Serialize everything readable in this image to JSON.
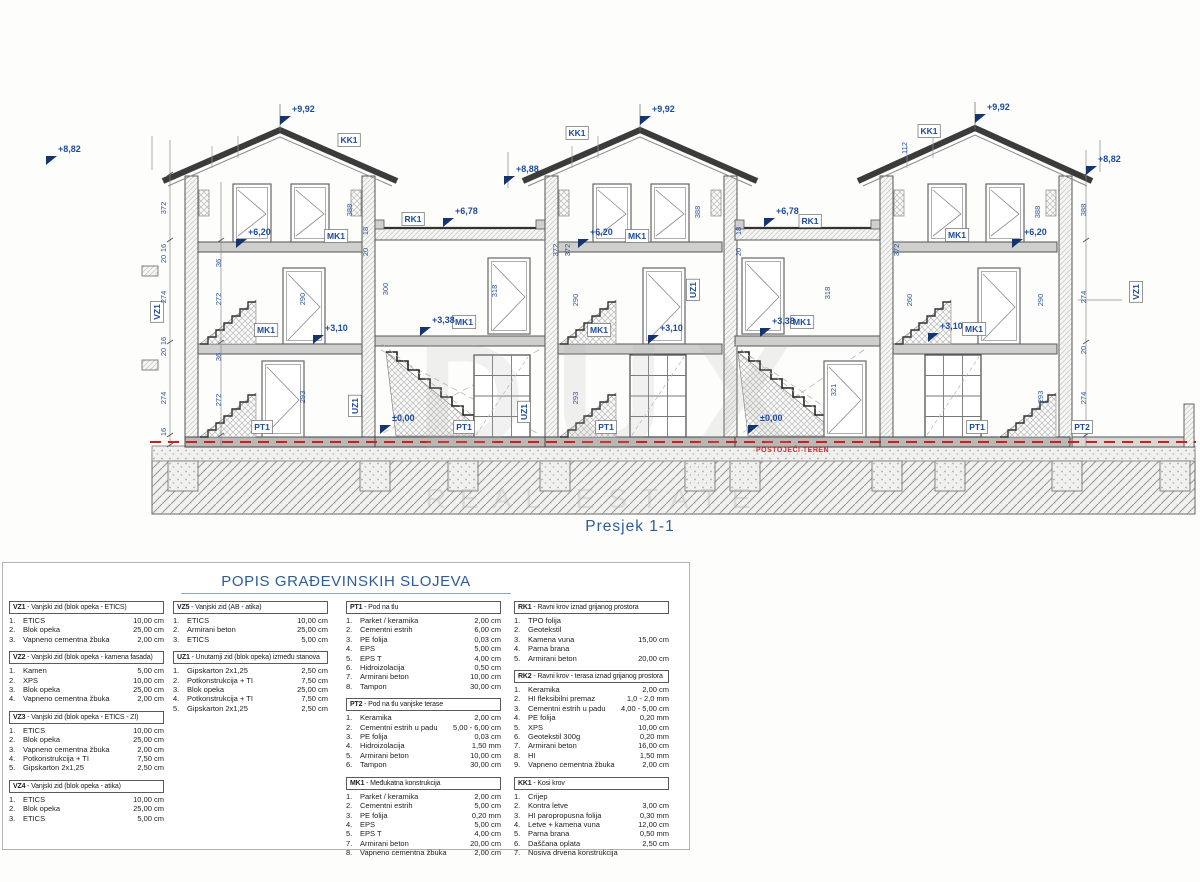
{
  "drawing": {
    "caption": "Presjek 1-1",
    "watermark_line1": "DUX",
    "watermark_line2": "REAL ESTATE",
    "terrain_label": "POSTOJEĆI TEREN",
    "colors": {
      "annotation_blue": "#1c4a9e",
      "terrain_red": "#d32f2f",
      "title_blue": "#2b5c9e"
    },
    "tags": [
      {
        "t": "KK1",
        "x": 349,
        "y": 140
      },
      {
        "t": "KK1",
        "x": 577,
        "y": 133
      },
      {
        "t": "KK1",
        "x": 929,
        "y": 131
      },
      {
        "t": "RK1",
        "x": 413,
        "y": 219
      },
      {
        "t": "RK1",
        "x": 810,
        "y": 221
      },
      {
        "t": "MK1",
        "x": 336,
        "y": 236
      },
      {
        "t": "MK1",
        "x": 637,
        "y": 236
      },
      {
        "t": "MK1",
        "x": 957,
        "y": 235
      },
      {
        "t": "MK1",
        "x": 266,
        "y": 330
      },
      {
        "t": "MK1",
        "x": 599,
        "y": 330
      },
      {
        "t": "MK1",
        "x": 974,
        "y": 329
      },
      {
        "t": "MK1",
        "x": 464,
        "y": 322
      },
      {
        "t": "MK1",
        "x": 802,
        "y": 322
      },
      {
        "t": "PT1",
        "x": 262,
        "y": 427
      },
      {
        "t": "PT1",
        "x": 464,
        "y": 427
      },
      {
        "t": "PT1",
        "x": 606,
        "y": 427
      },
      {
        "t": "PT1",
        "x": 977,
        "y": 427
      },
      {
        "t": "PT2",
        "x": 1082,
        "y": 427
      },
      {
        "t": "VZ1",
        "x": 157,
        "y": 312,
        "rot": 1
      },
      {
        "t": "VZ1",
        "x": 1136,
        "y": 292,
        "rot": 1
      },
      {
        "t": "UZ1",
        "x": 355,
        "y": 406,
        "rot": 1
      },
      {
        "t": "UZ1",
        "x": 524,
        "y": 412,
        "rot": 1
      },
      {
        "t": "UZ1",
        "x": 693,
        "y": 290,
        "rot": 1
      }
    ],
    "elevations": [
      {
        "t": "+9,92",
        "x": 292,
        "y": 112
      },
      {
        "t": "+9,92",
        "x": 652,
        "y": 112
      },
      {
        "t": "+9,92",
        "x": 987,
        "y": 110
      },
      {
        "t": "+8,82",
        "x": 58,
        "y": 152
      },
      {
        "t": "+8,88",
        "x": 516,
        "y": 172
      },
      {
        "t": "+8,82",
        "x": 1098,
        "y": 162
      },
      {
        "t": "+6,78",
        "x": 455,
        "y": 214
      },
      {
        "t": "+6,78",
        "x": 776,
        "y": 214
      },
      {
        "t": "+6,20",
        "x": 248,
        "y": 235
      },
      {
        "t": "+6,20",
        "x": 590,
        "y": 235
      },
      {
        "t": "+6,20",
        "x": 1024,
        "y": 235
      },
      {
        "t": "+3,10",
        "x": 325,
        "y": 331
      },
      {
        "t": "+3,10",
        "x": 660,
        "y": 331
      },
      {
        "t": "+3,10",
        "x": 940,
        "y": 329
      },
      {
        "t": "+3,38",
        "x": 432,
        "y": 323
      },
      {
        "t": "+3,38",
        "x": 772,
        "y": 324
      },
      {
        "t": "±0,00",
        "x": 392,
        "y": 421
      },
      {
        "t": "±0,00",
        "x": 760,
        "y": 421
      }
    ],
    "dims": [
      {
        "t": "372",
        "x": 166,
        "y": 208
      },
      {
        "t": "16",
        "x": 166,
        "y": 248
      },
      {
        "t": "20",
        "x": 166,
        "y": 259
      },
      {
        "t": "274",
        "x": 166,
        "y": 297
      },
      {
        "t": "16",
        "x": 166,
        "y": 341
      },
      {
        "t": "20",
        "x": 166,
        "y": 352
      },
      {
        "t": "274",
        "x": 166,
        "y": 398
      },
      {
        "t": "16",
        "x": 166,
        "y": 432
      },
      {
        "t": "36",
        "x": 221,
        "y": 263
      },
      {
        "t": "272",
        "x": 221,
        "y": 299
      },
      {
        "t": "36",
        "x": 221,
        "y": 357
      },
      {
        "t": "272",
        "x": 221,
        "y": 400
      },
      {
        "t": "388",
        "x": 352,
        "y": 210
      },
      {
        "t": "290",
        "x": 305,
        "y": 299
      },
      {
        "t": "293",
        "x": 305,
        "y": 397
      },
      {
        "t": "300",
        "x": 388,
        "y": 289
      },
      {
        "t": "318",
        "x": 497,
        "y": 291
      },
      {
        "t": "18",
        "x": 368,
        "y": 231
      },
      {
        "t": "20",
        "x": 368,
        "y": 252
      },
      {
        "t": "372",
        "x": 558,
        "y": 250
      },
      {
        "t": "372",
        "x": 570,
        "y": 250
      },
      {
        "t": "290",
        "x": 578,
        "y": 300
      },
      {
        "t": "293",
        "x": 578,
        "y": 398
      },
      {
        "t": "388",
        "x": 700,
        "y": 212
      },
      {
        "t": "318",
        "x": 830,
        "y": 293
      },
      {
        "t": "321",
        "x": 836,
        "y": 390
      },
      {
        "t": "18",
        "x": 741,
        "y": 231
      },
      {
        "t": "20",
        "x": 741,
        "y": 252
      },
      {
        "t": "112",
        "x": 907,
        "y": 148
      },
      {
        "t": "372",
        "x": 899,
        "y": 250
      },
      {
        "t": "260",
        "x": 912,
        "y": 300
      },
      {
        "t": "290",
        "x": 1043,
        "y": 300
      },
      {
        "t": "293",
        "x": 1043,
        "y": 397
      },
      {
        "t": "388",
        "x": 1040,
        "y": 212
      },
      {
        "t": "388",
        "x": 1086,
        "y": 210
      },
      {
        "t": "274",
        "x": 1086,
        "y": 297
      },
      {
        "t": "274",
        "x": 1086,
        "y": 398
      },
      {
        "t": "20",
        "x": 1086,
        "y": 350
      }
    ]
  },
  "table": {
    "title": "POPIS GRAĐEVINSKIH SLOJEVA",
    "columns": [
      {
        "blocks": [
          {
            "code": "VZ1",
            "title": "Vanjski zid (blok opeka - ETICS)",
            "rows": [
              [
                "1.",
                "ETICS",
                "10,00 cm"
              ],
              [
                "2.",
                "Blok opeka",
                "25,00 cm"
              ],
              [
                "3.",
                "Vapneno cementna žbuka",
                "2,00 cm"
              ]
            ]
          },
          {
            "code": "VZ2",
            "title": "Vanjski zid (blok opeka - kamena fasada)",
            "rows": [
              [
                "1.",
                "Kamen",
                "5,00 cm"
              ],
              [
                "2.",
                "XPS",
                "10,00 cm"
              ],
              [
                "3.",
                "Blok opeka",
                "25,00 cm"
              ],
              [
                "4.",
                "Vapneno cementna žbuka",
                "2,00 cm"
              ]
            ]
          },
          {
            "code": "VZ3",
            "title": "Vanjski zid (blok opeka - ETICS - ZI)",
            "rows": [
              [
                "1.",
                "ETICS",
                "10,00 cm"
              ],
              [
                "2.",
                "Blok opeka",
                "25,00 cm"
              ],
              [
                "3.",
                "Vapneno cementna žbuka",
                "2,00 cm"
              ],
              [
                "4.",
                "Potkonstrukcija + TI",
                "7,50 cm"
              ],
              [
                "5.",
                "Gipskarton 2x1,25",
                "2,50 cm"
              ]
            ]
          },
          {
            "code": "VZ4",
            "title": "Vanjski zid (blok opeka - atika)",
            "rows": [
              [
                "1.",
                "ETICS",
                "10,00 cm"
              ],
              [
                "2.",
                "Blok opeka",
                "25,00 cm"
              ],
              [
                "3.",
                "ETICS",
                "5,00 cm"
              ]
            ]
          }
        ]
      },
      {
        "blocks": [
          {
            "code": "VZ5",
            "title": "Vanjski zid (AB - atika)",
            "rows": [
              [
                "1.",
                "ETICS",
                "10,00 cm"
              ],
              [
                "2.",
                "Armirani beton",
                "25,00 cm"
              ],
              [
                "3.",
                "ETICS",
                "5,00 cm"
              ]
            ]
          },
          {
            "code": "UZ1",
            "title": "Unutarnji zid (blok opeka) između stanova",
            "rows": [
              [
                "1.",
                "Gipskarton 2x1,25",
                "2,50 cm"
              ],
              [
                "2.",
                "Potkonstrukcija + TI",
                "7,50 cm"
              ],
              [
                "3.",
                "Blok opeka",
                "25,00 cm"
              ],
              [
                "4.",
                "Potkonstrukcija + TI",
                "7,50 cm"
              ],
              [
                "5.",
                "Gipskarton 2x1,25",
                "2,50 cm"
              ]
            ]
          }
        ]
      },
      {
        "blocks": [
          {
            "code": "PT1",
            "title": "Pod na tlu",
            "rows": [
              [
                "1.",
                "Parket / keramika",
                "2,00 cm"
              ],
              [
                "2.",
                "Cementni estrih",
                "6,00 cm"
              ],
              [
                "3.",
                "PE folija",
                "0,03 cm"
              ],
              [
                "4.",
                "EPS",
                "5,00 cm"
              ],
              [
                "5.",
                "EPS T",
                "4,00 cm"
              ],
              [
                "6.",
                "Hidroizolacija",
                "0,50 cm"
              ],
              [
                "7.",
                "Armirani beton",
                "10,00 cm"
              ],
              [
                "8.",
                "Tampon",
                "30,00 cm"
              ]
            ]
          },
          {
            "code": "PT2",
            "title": "Pod na tlu vanjske terase",
            "rows": [
              [
                "1.",
                "Keramika",
                "2,00 cm"
              ],
              [
                "2.",
                "Cementni estrih u padu",
                "5,00 - 6,00 cm"
              ],
              [
                "3.",
                "PE folija",
                "0,03 cm"
              ],
              [
                "4.",
                "Hidroizolacija",
                "1,50 mm"
              ],
              [
                "5.",
                "Armirani beton",
                "10,00 cm"
              ],
              [
                "6.",
                "Tampon",
                "30,00 cm"
              ]
            ]
          },
          {
            "code": "MK1",
            "title": "Međukatna konstrukcija",
            "rows": [
              [
                "1.",
                "Parket / keramika",
                "2,00 cm"
              ],
              [
                "2.",
                "Cementni estrih",
                "5,00 cm"
              ],
              [
                "3.",
                "PE folija",
                "0,20 mm"
              ],
              [
                "4.",
                "EPS",
                "5,00 cm"
              ],
              [
                "5.",
                "EPS T",
                "4,00 cm"
              ],
              [
                "7.",
                "Armirani beton",
                "20,00 cm"
              ],
              [
                "8.",
                "Vapneno cementna žbuka",
                "2,00 cm"
              ]
            ]
          }
        ]
      },
      {
        "blocks": [
          {
            "code": "RK1",
            "title": "Ravni krov iznad grijanog prostora",
            "rows": [
              [
                "1.",
                "TPO folija",
                ""
              ],
              [
                "2.",
                "Geotekstil",
                ""
              ],
              [
                "3.",
                "Kamena vuna",
                "15,00 cm"
              ],
              [
                "4.",
                "Parna brana",
                ""
              ],
              [
                "5.",
                "Armirani beton",
                "20,00 cm"
              ]
            ]
          },
          {
            "code": "RK2",
            "title": "Ravni krov - terasa iznad grijanog prostora",
            "rows": [
              [
                "1.",
                "Keramika",
                "2,00 cm"
              ],
              [
                "2.",
                "HI fleksibilni premaz",
                "1,0 - 2,0 mm"
              ],
              [
                "3.",
                "Cementni estrih u padu",
                "4,00 - 5,00 cm"
              ],
              [
                "4.",
                "PE folija",
                "0,20 mm"
              ],
              [
                "5.",
                "XPS",
                "10,00 cm"
              ],
              [
                "6.",
                "Geotekstil 300g",
                "0,20 mm"
              ],
              [
                "7.",
                "Armirani beton",
                "16,00 cm"
              ],
              [
                "8.",
                "HI",
                "1,50 mm"
              ],
              [
                "9.",
                "Vapneno cementna žbuka",
                "2,00 cm"
              ]
            ]
          },
          {
            "code": "KK1",
            "title": "Kosi krov",
            "rows": [
              [
                "1.",
                "Crijep",
                ""
              ],
              [
                "2.",
                "Kontra letve",
                "3,00 cm"
              ],
              [
                "3.",
                "HI paropropusna folija",
                "0,30 mm"
              ],
              [
                "4.",
                "Letve + kamena vuna",
                "12,00 cm"
              ],
              [
                "5.",
                "Parna brana",
                "0,50 mm"
              ],
              [
                "6.",
                "Daščana oplata",
                "2,50 cm"
              ],
              [
                "7.",
                "Nosiva drvena konstrukcija",
                ""
              ]
            ]
          }
        ]
      }
    ]
  }
}
